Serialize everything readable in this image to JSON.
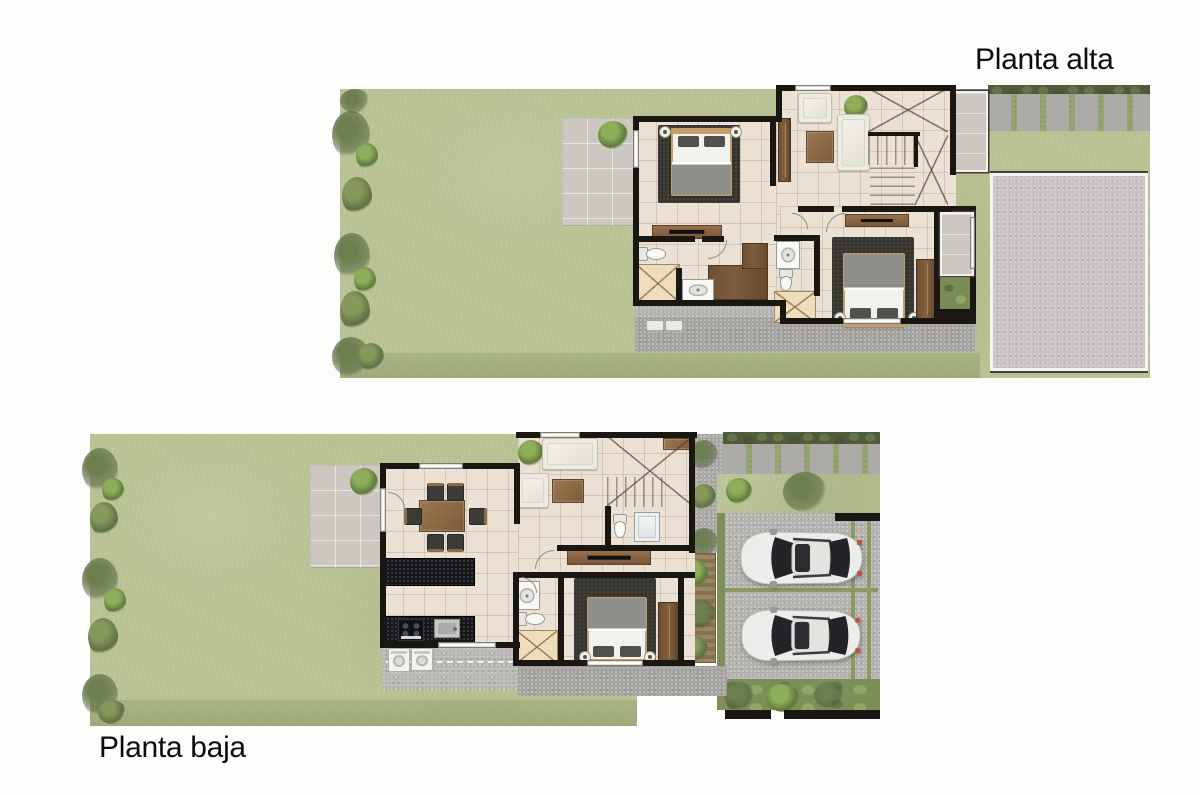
{
  "page": {
    "background": "#fdfdfc"
  },
  "labels": {
    "planta_alta": "Planta alta",
    "planta_baja": "Planta baja"
  },
  "palette": {
    "label": "#0c0c0c",
    "grass": "#b8c192",
    "foliage": "#5f7044",
    "hedge": "#4e5c3b",
    "terrace": "#cdc7c2",
    "floor": "#ebe1d4",
    "wall": "#1a1713",
    "rug": "#35342e",
    "wood": "#8d6a45",
    "wood_dark": "#67492f",
    "counter": "#17181b",
    "whitefurn": "#edeae1",
    "fixture": "#f8f8f5",
    "shower": "#eedcbb",
    "sidewalk": "#a4a39f",
    "driveway": "#b3b2ae",
    "pave": "#acaba7",
    "slab": "#c9c2c2",
    "car": "#ececea",
    "glass": "#222428",
    "bedframe": "#c49e69",
    "duvet": "#f2f1ed",
    "blanket": "#8f8f8b",
    "pillow": "#50504e"
  },
  "plans": {
    "planta_alta": {
      "label": "Planta alta",
      "rooms": [
        "garden",
        "terrace",
        "bedroom-1",
        "bedroom-2",
        "bathroom-1",
        "bathroom-2",
        "walk-in-closet",
        "tv-lounge",
        "stairs",
        "balcony",
        "window-bay",
        "pergola",
        "side-walkway",
        "roof-slab",
        "service-sidewalk"
      ]
    },
    "planta_baja": {
      "label": "Planta baja",
      "rooms": [
        "garden",
        "terrace",
        "dining-room",
        "living-room",
        "kitchen",
        "bedroom",
        "bathroom",
        "powder-shower-room",
        "stairs",
        "hall",
        "wood-deck",
        "service-yard",
        "side-path",
        "walkway",
        "driveway",
        "parking-two-cars"
      ]
    }
  }
}
